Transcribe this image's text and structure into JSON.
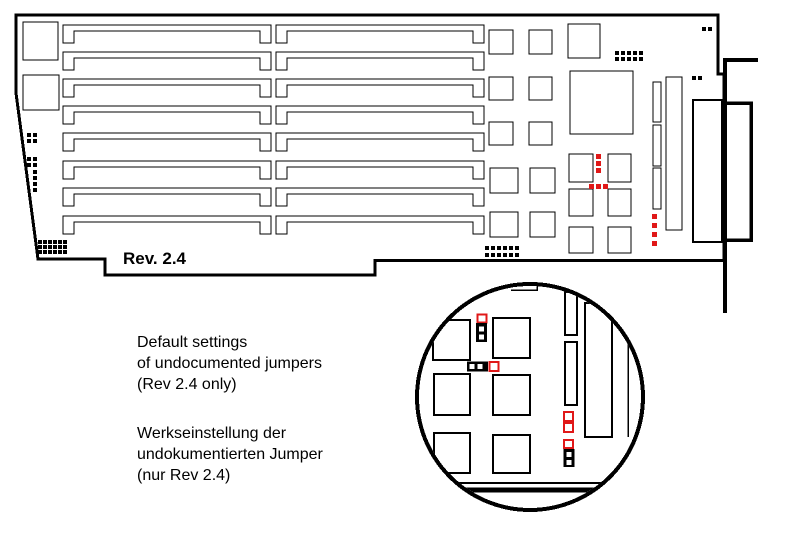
{
  "labels": {
    "rev": "Rev. 2.4"
  },
  "captions": {
    "en": [
      "Default settings",
      "of undocumented jumpers",
      "(Rev 2.4 only)"
    ],
    "de": [
      "Werkseinstellung der",
      "undokumentierten Jumper",
      "(nur Rev 2.4)"
    ]
  },
  "colors": {
    "red": "#e01818",
    "line": "#000000",
    "bg": "#ffffff"
  },
  "magnifier": {
    "jumper_states": [
      {
        "id": "vertical-3pin-jumper",
        "pins": 3,
        "orientation": "vertical",
        "capped_pins": "bottom 2",
        "open_pins": "top 1"
      },
      {
        "id": "horizontal-3pin-jumper",
        "pins": 3,
        "orientation": "horizontal",
        "capped_pins": "left 2",
        "open_pins": "right 1"
      },
      {
        "id": "right-column-5pin-jumper",
        "pins": 5,
        "orientation": "vertical",
        "capped_pins": "bottom 2",
        "open_pins": "top 3"
      }
    ]
  }
}
